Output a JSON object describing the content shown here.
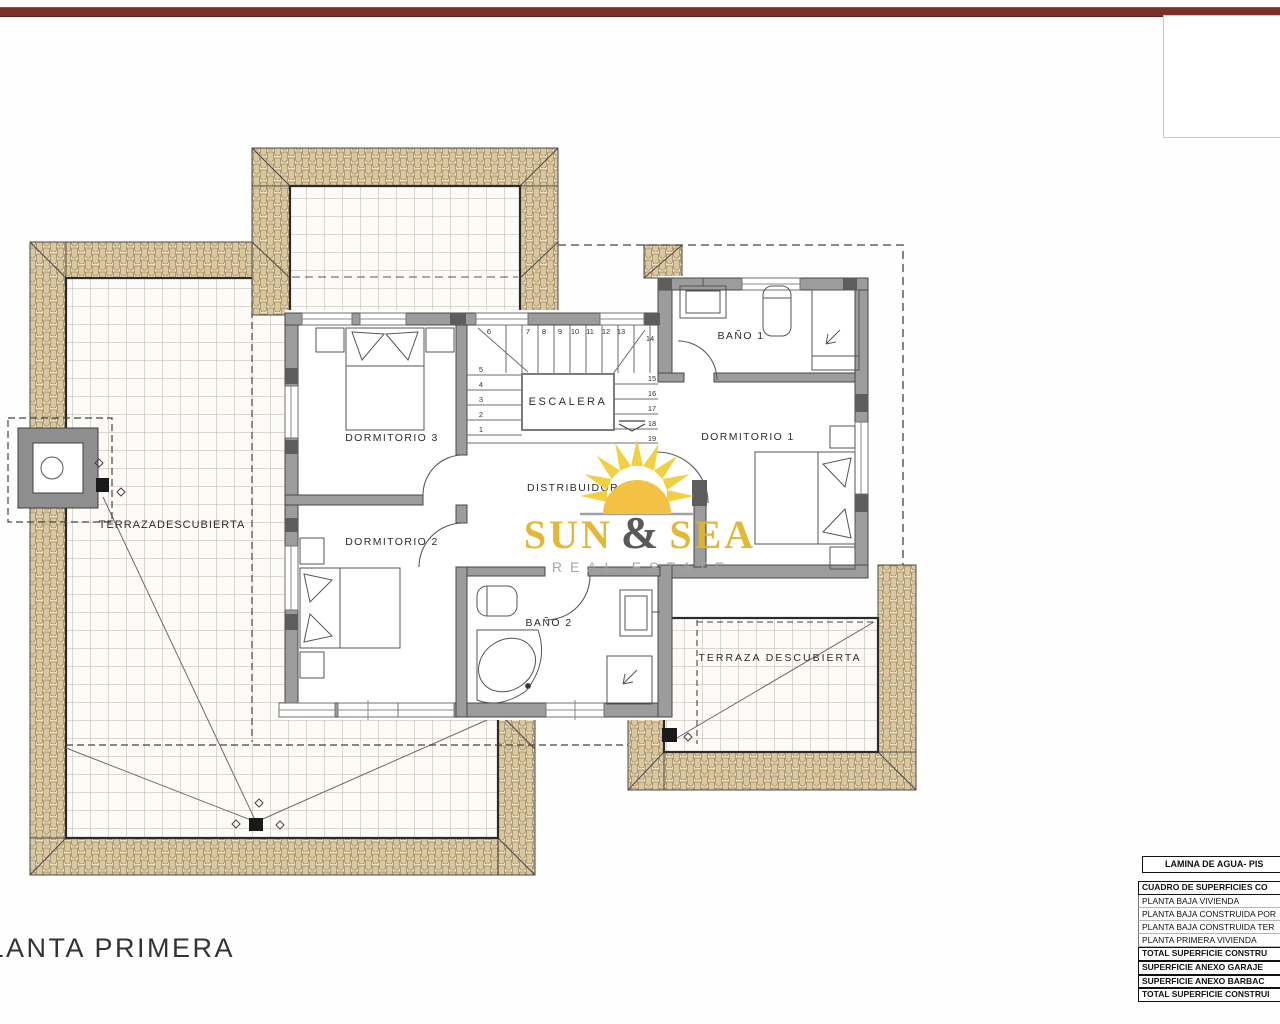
{
  "plan": {
    "title": "PLANTA PRIMERA",
    "rooms": {
      "dormitorio1": "DORMITORIO 1",
      "dormitorio2": "DORMITORIO 2",
      "dormitorio3": "DORMITORIO 3",
      "bano1": "BAÑO 1",
      "bano2": "BAÑO 2",
      "escalera": "ESCALERA",
      "distribuidor": "DISTRIBUIDOR",
      "terraza_izquierda": "TERRAZADESCUBIERTA",
      "terraza_derecha": "TERRAZA DESCUBIERTA"
    },
    "stairs": {
      "top": [
        "6",
        "7",
        "8",
        "9",
        "10",
        "11",
        "12",
        "13"
      ],
      "right_top": "14",
      "left": [
        "5",
        "4",
        "3",
        "2",
        "1"
      ],
      "right": [
        "15",
        "16",
        "17",
        "18",
        "19"
      ]
    }
  },
  "logo": {
    "word1": "SUN",
    "amp": "&",
    "word2": "SEA",
    "tagline": "REAL ESTATE"
  },
  "table": {
    "header": "LAMINA DE AGUA- PIS",
    "rows": [
      "CUADRO DE SUPERFICIES CO",
      "PLANTA BAJA VIVIENDA",
      "PLANTA BAJA CONSTRUIDA POR",
      "PLANTA BAJA CONSTRUIDA TER",
      "PLANTA PRIMERA VIVIENDA",
      "TOTAL SUPERFICIE CONSTRU",
      "SUPERFICIE ANEXO GARAJE",
      "SUPERFICIE ANEXO BARBAC",
      "TOTAL SUPERFICIE CONSTRUI"
    ]
  },
  "colors": {
    "accent_red": "#7e2e29",
    "logo_gold": "#e1b52c",
    "tile_beige": "#ece0c6",
    "wall_gray": "#9c9c9c"
  }
}
